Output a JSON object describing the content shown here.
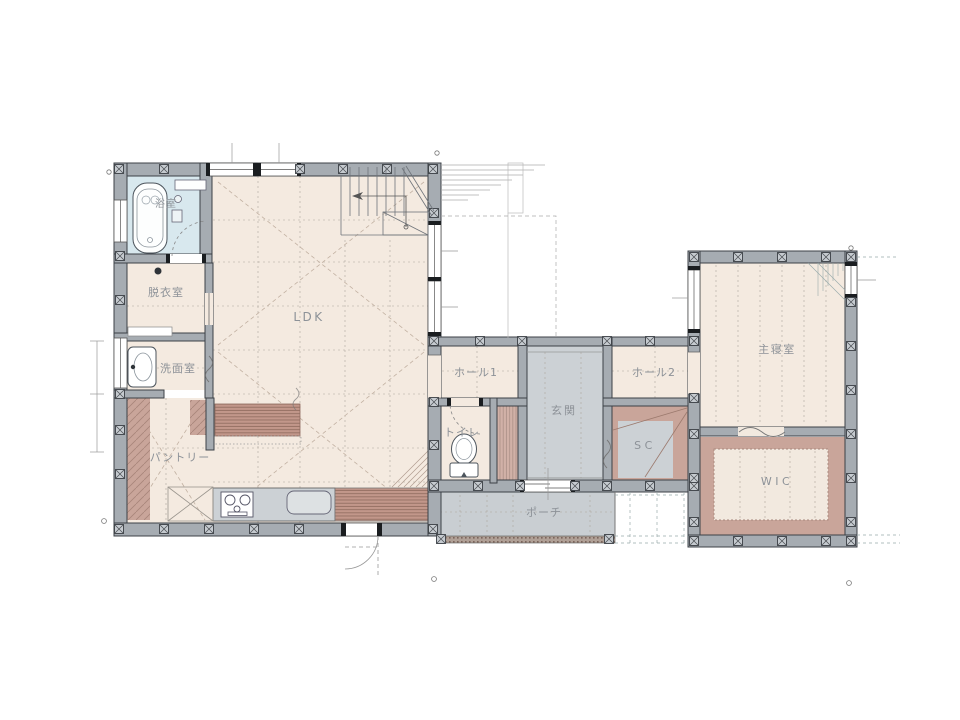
{
  "rooms": {
    "bath": {
      "label": "浴室"
    },
    "dressing_room": {
      "label": "脱衣室"
    },
    "washroom": {
      "label": "洗面室"
    },
    "ldk": {
      "label": "LDK"
    },
    "pantry": {
      "label": "パントリー"
    },
    "hall1": {
      "label": "ホール1"
    },
    "toilet": {
      "label": "トイレ"
    },
    "entrance": {
      "label": "玄関"
    },
    "hall2": {
      "label": "ホール2"
    },
    "shoes_closet": {
      "label": "SC"
    },
    "porch": {
      "label": "ポーチ"
    },
    "master_bedroom": {
      "label": "主寝室"
    },
    "walk_in_closet": {
      "label": "WIC"
    }
  },
  "colors": {
    "wall_fill": "#a6acb2",
    "wall_line": "#3c4147",
    "floor_cream": "#f4eae0",
    "floor_gray": "#ccd1d5",
    "porch_gray": "#c9ced2",
    "bath_blue": "#d8e8ee",
    "closet_mauve": "#c9a59a",
    "wood_brown": "#bd9184",
    "grid_line": "#b9a99b",
    "label_text": "#8d9298"
  }
}
